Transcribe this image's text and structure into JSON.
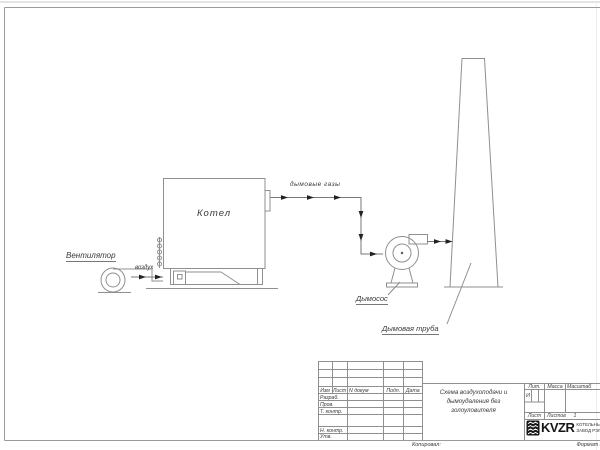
{
  "diagram": {
    "fan_label": "Вентилятор",
    "air_label": "воздух",
    "boiler_label": "Котел",
    "flue_gases_label": "дымовые газы",
    "exhauster_label": "Дымосос",
    "chimney_label": "Дымовая труба"
  },
  "title_block": {
    "header_cols": [
      "Изм",
      "Лист",
      "N докум",
      "Подп.",
      "Дата"
    ],
    "rows": [
      "Разраб.",
      "Пров.",
      "Т. контр.",
      "Н. контр.",
      "Утв."
    ],
    "doc_title_lines": [
      "Схема воздухоподачи и",
      "дымоудаления без",
      "золоуловителя"
    ],
    "lit_label": "Лит.",
    "lit_value": "И",
    "mass_label": "Масса",
    "scale_label": "Масштаб",
    "sheet_label": "Лист",
    "sheets_label": "Листов",
    "sheets_value": "1",
    "company": {
      "logo_text": "KVZR",
      "name_line1": "КОТЕЛЬНЫЙ",
      "name_line2": "ЗАВОД РЭП"
    }
  },
  "page": {
    "copied_label": "Копировал:",
    "format_label": "Формат А3"
  },
  "colors": {
    "thin_line": "#8f8f8f",
    "duct_line": "#777777",
    "arrow_fill": "#222222",
    "text": "#3a3a3a"
  }
}
